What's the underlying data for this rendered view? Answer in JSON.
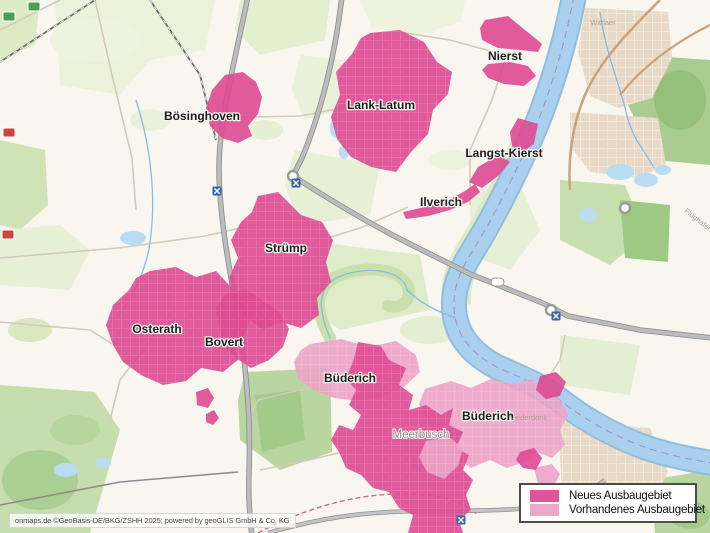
{
  "attribution": "onmaps.de ©GeoBasis-DE/BKG/ZSHH 2025; powered by geoGLIS GmbH & Co. KG",
  "legend": {
    "items": [
      {
        "id": "neues",
        "label": "Neues Ausbaugebiet",
        "color": "#e0549b"
      },
      {
        "id": "vorhandenes",
        "label": "Vorhandenes Ausbaugebiet",
        "color": "#eda7cb"
      }
    ]
  },
  "map": {
    "colors": {
      "neues": "#de4a92",
      "vorhandenes": "#eca3c8",
      "water": "#a9d1ef",
      "place_label": "#1c1c1c",
      "base_label": "#8f8f8f"
    },
    "labels": [
      {
        "text": "Nierst",
        "x": 505,
        "y": 60,
        "cls": "place"
      },
      {
        "text": "Lank-Latum",
        "x": 381,
        "y": 109,
        "cls": "place"
      },
      {
        "text": "Bösinghoven",
        "x": 202,
        "y": 120,
        "cls": "place"
      },
      {
        "text": "Langst-Kierst",
        "x": 504,
        "y": 157,
        "cls": "place"
      },
      {
        "text": "Ilverich",
        "x": 441,
        "y": 206,
        "cls": "place"
      },
      {
        "text": "Strümp",
        "x": 286,
        "y": 252,
        "cls": "place"
      },
      {
        "text": "Osterath",
        "x": 157,
        "y": 333,
        "cls": "place"
      },
      {
        "text": "Bovert",
        "x": 224,
        "y": 346,
        "cls": "place"
      },
      {
        "text": "Büderich",
        "x": 350,
        "y": 382,
        "cls": "place"
      },
      {
        "text": "Büderich",
        "x": 488,
        "y": 420,
        "cls": "place"
      },
      {
        "text": "Meerbusch",
        "x": 421,
        "y": 438,
        "cls": "city"
      },
      {
        "text": "Wittlaer",
        "x": 603,
        "y": 25,
        "cls": "tiny"
      },
      {
        "text": "Niederdonk",
        "x": 528,
        "y": 420,
        "cls": "tiny"
      },
      {
        "text": "Flughafen",
        "x": 697,
        "y": 222,
        "cls": "tiny",
        "rot": 38
      }
    ],
    "areas": [
      {
        "name": "buederich-west",
        "type": "vorhandenes",
        "textured": true,
        "points": "310,344 341,339 369,347 396,341 416,355 420,372 405,386 385,396 359,401 334,398 314,390 298,379 294,362 301,350"
      },
      {
        "name": "meerbusch-ost",
        "type": "vorhandenes",
        "textured": true,
        "points": "425,389 451,381 471,388 491,379 511,384 531,379 549,390 561,401 568,415 560,430 565,445 552,458 537,452 524,462 507,468 490,460 471,468 457,458 444,448 437,432 427,419 419,404"
      },
      {
        "name": "legend-sued-licht",
        "type": "vorhandenes",
        "textured": false,
        "points": "534,468 552,464 560,474 554,486 538,484"
      },
      {
        "name": "boesinghoven",
        "type": "neues",
        "textured": false,
        "points": "225,75 243,72 256,82 262,97 258,114 248,126 252,136 238,143 222,138 210,126 206,108 212,90"
      },
      {
        "name": "lank-latum",
        "type": "neues",
        "textured": true,
        "points": "370,33 400,30 424,42 437,62 452,72 448,94 433,110 428,134 411,152 396,172 371,167 351,157 337,139 331,117 340,95 336,72 352,54 361,38"
      },
      {
        "name": "nierst-nord",
        "type": "neues",
        "textured": false,
        "points": "485,20 508,16 520,26 530,34 542,44 538,52 520,50 498,48 482,40 480,28"
      },
      {
        "name": "nierst-sued",
        "type": "neues",
        "textured": false,
        "points": "488,64 510,62 528,66 536,76 524,86 504,84 488,78 482,70"
      },
      {
        "name": "langst-kierst-nord",
        "type": "neues",
        "textured": false,
        "points": "518,118 538,124 534,144 522,152 512,146 510,132"
      },
      {
        "name": "langst-kierst-sued",
        "type": "neues",
        "textured": false,
        "points": "500,156 510,162 498,176 482,188 469,182 478,167 490,160"
      },
      {
        "name": "ilverich",
        "type": "neues",
        "textured": false,
        "points": "403,212 425,207 447,201 465,191 475,184 480,192 468,202 450,210 428,216 406,219"
      },
      {
        "name": "struemp",
        "type": "neues",
        "textured": true,
        "points": "258,196 278,192 291,205 301,215 322,222 333,240 326,262 331,282 317,298 319,315 301,328 281,322 263,330 247,318 234,300 229,278 238,258 231,240 241,222 252,212"
      },
      {
        "name": "osterath",
        "type": "neues",
        "textured": true,
        "points": "150,271 176,267 196,277 216,271 229,285 241,300 252,315 246,332 233,345 239,359 223,372 201,368 186,381 163,385 141,375 123,362 113,345 106,325 113,305 129,290 136,278"
      },
      {
        "name": "bovert",
        "type": "neues",
        "textured": true,
        "points": "226,294 246,289 263,301 279,312 289,329 283,347 269,360 251,368 236,358 223,345 219,325 216,308"
      },
      {
        "name": "osterath-sued-1",
        "type": "neues",
        "textured": false,
        "points": "196,392 208,388 214,398 208,408 197,405"
      },
      {
        "name": "osterath-sued-2",
        "type": "neues",
        "textured": false,
        "points": "206,414 214,410 219,418 213,425 206,422"
      },
      {
        "name": "meerbusch-sued",
        "type": "neues",
        "textured": true,
        "points": "358,342 381,346 389,360 406,368 399,385 413,395 409,410 426,405 441,415 453,408 449,425 463,432 456,448 469,455 463,470 473,480 466,495 471,510 459,520 463,533 408,533 413,515 399,508 389,492 373,488 361,475 346,468 339,452 331,440 339,425 353,430 361,415 349,405 356,390 346,378 353,362"
      },
      {
        "name": "buederich-ost-dunkel",
        "type": "neues",
        "textured": false,
        "points": "540,376 556,372 566,382 560,396 546,399 536,390"
      },
      {
        "name": "sued-dunkel",
        "type": "neues",
        "textured": false,
        "points": "520,452 534,448 542,458 536,470 523,468 516,460"
      },
      {
        "name": "meerbusch-innen-licht",
        "type": "vorhandenes",
        "textured": true,
        "points": "426,441 449,437 463,448 458,466 444,479 427,472 419,457"
      }
    ],
    "icons": {
      "junctions": [
        {
          "x": 217,
          "y": 191
        },
        {
          "x": 296,
          "y": 183
        },
        {
          "x": 556,
          "y": 316
        },
        {
          "x": 461,
          "y": 520
        }
      ],
      "roundabouts": [
        {
          "x": 293,
          "y": 176
        },
        {
          "x": 551,
          "y": 310
        },
        {
          "x": 625,
          "y": 208
        }
      ],
      "shields": [
        {
          "x": 3,
          "y": 12,
          "color": "#4a9e52"
        },
        {
          "x": 3,
          "y": 128,
          "color": "#cc4444"
        },
        {
          "x": 2,
          "y": 230,
          "color": "#cc4444"
        },
        {
          "x": 28,
          "y": 2,
          "color": "#4a9e52"
        }
      ]
    }
  }
}
